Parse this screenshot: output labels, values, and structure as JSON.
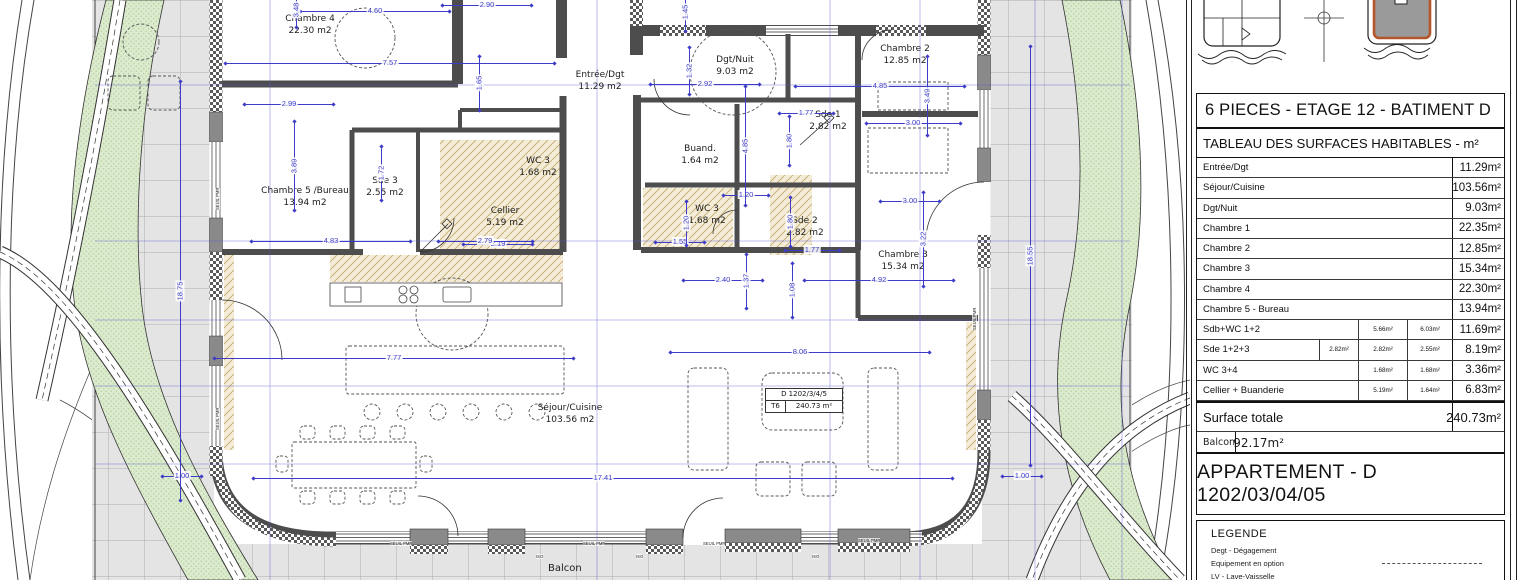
{
  "plan": {
    "rooms": [
      {
        "name": "Chambre 4",
        "area": "22.30 m2",
        "x": 310,
        "y": 14
      },
      {
        "name": "Entrée/Dgt",
        "area": "11.29 m2",
        "x": 600,
        "y": 70
      },
      {
        "name": "Dgt/Nuit",
        "area": "9.03 m2",
        "x": 735,
        "y": 55
      },
      {
        "name": "Chambre 2",
        "area": "12.85 m2",
        "x": 905,
        "y": 44
      },
      {
        "name": "Sde 1",
        "area": "2.82 m2",
        "x": 828,
        "y": 110
      },
      {
        "name": "Buand.",
        "area": "1.64 m2",
        "x": 700,
        "y": 144
      },
      {
        "name": "WC 3",
        "area": "1.68 m2",
        "x": 538,
        "y": 156
      },
      {
        "name": "Sde 3",
        "area": "2.55 m2",
        "x": 385,
        "y": 176
      },
      {
        "name": "Chambre 5 /Bureau",
        "area": "13.94 m2",
        "x": 305,
        "y": 186
      },
      {
        "name": "Cellier",
        "area": "5.19 m2",
        "x": 505,
        "y": 206
      },
      {
        "name": "WC 3",
        "area": "1.68 m2",
        "x": 707,
        "y": 204
      },
      {
        "name": "Sde 2",
        "area": "2.82 m2",
        "x": 805,
        "y": 216
      },
      {
        "name": "Chambre 3",
        "area": "15.34 m2",
        "x": 903,
        "y": 250
      },
      {
        "name": "Séjour/Cuisine",
        "area": "103.56 m2",
        "x": 570,
        "y": 403
      }
    ],
    "dims_h": [
      {
        "v": "4.60",
        "x": 375,
        "y": 10,
        "len": 150
      },
      {
        "v": "2.90",
        "x": 487,
        "y": 4,
        "len": 90
      },
      {
        "v": "7.57",
        "x": 390,
        "y": 62,
        "len": 330
      },
      {
        "v": "2.99",
        "x": 289,
        "y": 103,
        "len": 90
      },
      {
        "v": "2.92",
        "x": 705,
        "y": 83,
        "len": 110
      },
      {
        "v": "4.85",
        "x": 880,
        "y": 85,
        "len": 170
      },
      {
        "v": "1.77",
        "x": 806,
        "y": 112,
        "len": 55
      },
      {
        "v": "3.00",
        "x": 913,
        "y": 122,
        "len": 95
      },
      {
        "v": "1.20",
        "x": 746,
        "y": 194,
        "len": 46
      },
      {
        "v": "3.00",
        "x": 910,
        "y": 200,
        "len": 60
      },
      {
        "v": "1.55",
        "x": 680,
        "y": 241,
        "len": 50
      },
      {
        "v": "1.77",
        "x": 812,
        "y": 249,
        "len": 55
      },
      {
        "v": "2.19",
        "x": 498,
        "y": 243,
        "len": 70
      },
      {
        "v": "4.83",
        "x": 331,
        "y": 240,
        "len": 160
      },
      {
        "v": "2.79",
        "x": 485,
        "y": 240,
        "len": 95
      },
      {
        "v": "2.40",
        "x": 723,
        "y": 279,
        "len": 80
      },
      {
        "v": "4.92",
        "x": 879,
        "y": 279,
        "len": 150
      },
      {
        "v": "7.77",
        "x": 394,
        "y": 357,
        "len": 360
      },
      {
        "v": "8.06",
        "x": 800,
        "y": 351,
        "len": 260
      },
      {
        "v": "17.41",
        "x": 603,
        "y": 477,
        "len": 700
      },
      {
        "v": "1.00",
        "x": 182,
        "y": 475,
        "len": 40
      },
      {
        "v": "1.00",
        "x": 1022,
        "y": 475,
        "len": 40
      }
    ],
    "dims_v": [
      {
        "v": "3.48",
        "x": 295,
        "y": 10,
        "len": 36
      },
      {
        "v": "1.45",
        "x": 684,
        "y": 12,
        "len": 40
      },
      {
        "v": "1.32",
        "x": 688,
        "y": 71,
        "len": 48
      },
      {
        "v": "1.65",
        "x": 478,
        "y": 83,
        "len": 55
      },
      {
        "v": "3.49",
        "x": 926,
        "y": 96,
        "len": 80
      },
      {
        "v": "1.80",
        "x": 788,
        "y": 141,
        "len": 50
      },
      {
        "v": "4.85",
        "x": 744,
        "y": 146,
        "len": 120
      },
      {
        "v": "3.89",
        "x": 293,
        "y": 166,
        "len": 90
      },
      {
        "v": "1.72",
        "x": 380,
        "y": 173,
        "len": 55
      },
      {
        "v": "18.75",
        "x": 179,
        "y": 291,
        "len": 420
      },
      {
        "v": "1.20",
        "x": 685,
        "y": 223,
        "len": 45
      },
      {
        "v": "1.80",
        "x": 789,
        "y": 222,
        "len": 50
      },
      {
        "v": "3.22",
        "x": 922,
        "y": 239,
        "len": 95
      },
      {
        "v": "18.55",
        "x": 1029,
        "y": 256,
        "len": 420
      },
      {
        "v": "1.37",
        "x": 745,
        "y": 281,
        "len": 55
      },
      {
        "v": "1.08",
        "x": 791,
        "y": 290,
        "len": 55
      }
    ],
    "window_labels": [
      {
        "t": "SEUIL PMR",
        "x": 390,
        "y": 541
      },
      {
        "t": "SEUIL PMR",
        "x": 583,
        "y": 541
      },
      {
        "t": "SEUIL PMR",
        "x": 703,
        "y": 541
      },
      {
        "t": "SEUIL PMR",
        "x": 858,
        "y": 538
      },
      {
        "t": "ISO",
        "x": 536,
        "y": 554
      },
      {
        "t": "ISO",
        "x": 636,
        "y": 554
      },
      {
        "t": "ISO",
        "x": 812,
        "y": 554
      },
      {
        "t": "SEUIL PMR",
        "x": 215,
        "y": 210,
        "rot": true
      },
      {
        "t": "SEUIL PMR",
        "x": 215,
        "y": 430,
        "rot": true
      },
      {
        "t": "SEUIL PMR",
        "x": 972,
        "y": 330,
        "rot": true
      }
    ],
    "tag_box": {
      "line1": "D 1202/3/4/5",
      "unit": "T6",
      "area": "240.73 m²"
    },
    "balcon_label": "Balcon"
  },
  "panel": {
    "title": "6 PIECES - ETAGE 12 - BATIMENT D",
    "table": {
      "header": "TABLEAU DES SURFACES HABITABLES - m²",
      "rows": [
        {
          "label": "Entrée/Dgt",
          "subs": [
            null,
            null,
            null
          ],
          "total": "11.29m²"
        },
        {
          "label": "Séjour/Cuisine",
          "subs": [
            null,
            null,
            null
          ],
          "total": "103.56m²"
        },
        {
          "label": "Dgt/Nuit",
          "subs": [
            null,
            null,
            null
          ],
          "total": "9.03m²"
        },
        {
          "label": "Chambre 1",
          "subs": [
            null,
            null,
            null
          ],
          "total": "22.35m²"
        },
        {
          "label": "Chambre 2",
          "subs": [
            null,
            null,
            null
          ],
          "total": "12.85m²"
        },
        {
          "label": "Chambre 3",
          "subs": [
            null,
            null,
            null
          ],
          "total": "15.34m²"
        },
        {
          "label": "Chambre 4",
          "subs": [
            null,
            null,
            null
          ],
          "total": "22.30m²"
        },
        {
          "label": "Chambre 5 - Bureau",
          "subs": [
            null,
            null,
            null
          ],
          "total": "13.94m²"
        },
        {
          "label": "Sdb+WC 1+2",
          "subs": [
            null,
            "5.66m²",
            "6.03m²"
          ],
          "total": "11.69m²"
        },
        {
          "label": "Sde 1+2+3",
          "subs": [
            "2.82m²",
            "2.82m²",
            "2.55m²"
          ],
          "total": "8.19m²"
        },
        {
          "label": "WC 3+4",
          "subs": [
            null,
            "1.68m²",
            "1.68m²"
          ],
          "total": "3.36m²"
        },
        {
          "label": "Cellier + Buanderie",
          "subs": [
            null,
            "5.19m²",
            "1.64m²"
          ],
          "total": "6.83m²"
        }
      ],
      "total_row": {
        "label": "Surface totale",
        "value": "240.73m²"
      },
      "balcony_row": {
        "label": "Balcon",
        "value": "92.17m²"
      }
    },
    "apartment_title": "APPARTEMENT - D 1202/03/04/05",
    "legend": {
      "title": "LEGENDE",
      "items": [
        {
          "label": "Degt - Dégagement"
        },
        {
          "label": "Equipement en option",
          "dashed": true
        },
        {
          "label": "LV - Lave-Vaisselle"
        }
      ]
    }
  },
  "colors": {
    "dim_blue": "#3c3cc8",
    "wall": "#4d4d4d",
    "green": "#dcead0",
    "tan": "#f4ecd6",
    "tile": "#e4e4e4",
    "accent_orange": "#b5552a"
  }
}
